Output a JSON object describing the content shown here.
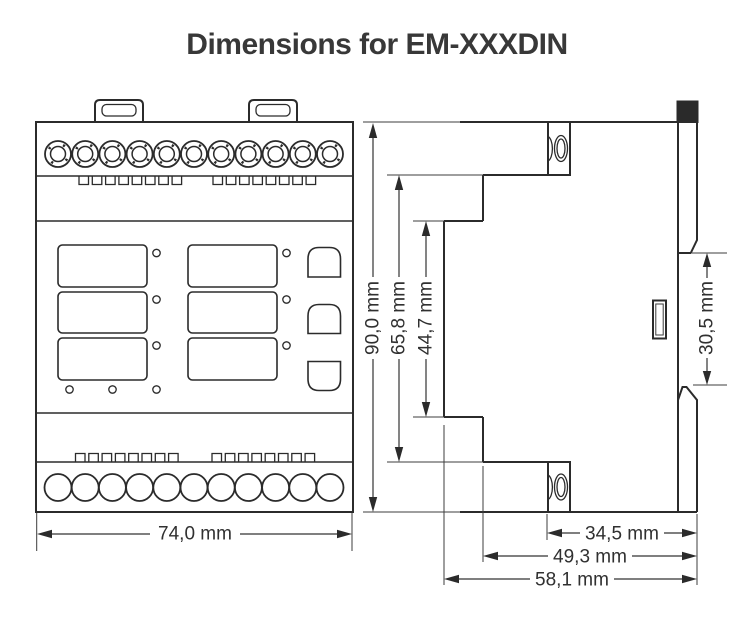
{
  "title": "Dimensions for EM-XXXDIN",
  "dimensions": {
    "front_width": "74,0 mm",
    "overall_height": "90,0 mm",
    "terminal_span_height": "65,8 mm",
    "front_face_height": "44,7 mm",
    "din_clip_gap": "30,5 mm",
    "depth_to_terminal": "34,5 mm",
    "depth_to_step": "49,3 mm",
    "overall_depth": "58,1 mm"
  }
}
